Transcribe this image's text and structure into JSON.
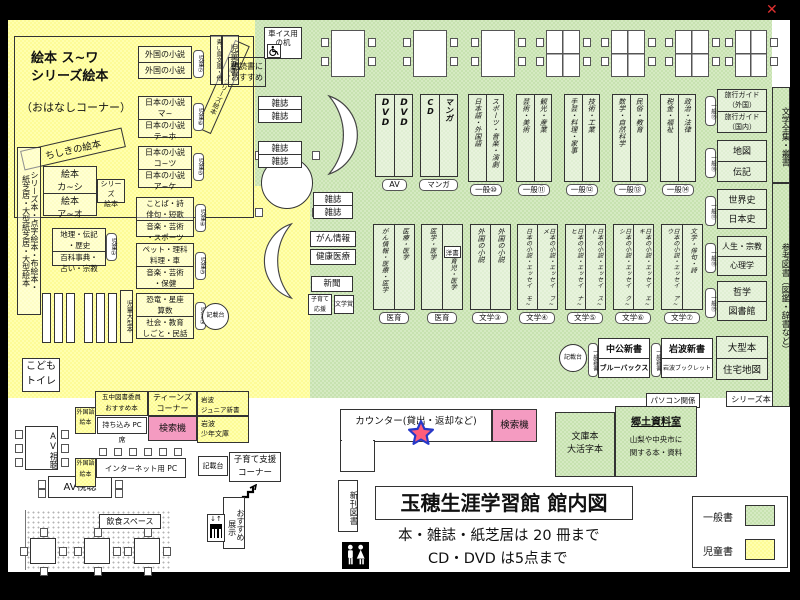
{
  "window": {
    "close": "✕"
  },
  "title": {
    "main": "玉穂生涯学習館 館内図",
    "note1": "本・雑誌・紙芝居は 20 冊まで",
    "note2": "CD・DVD は5点まで"
  },
  "legend": {
    "general_label": "一般書",
    "children_label": "児童書",
    "general_color": "#cde5b4",
    "children_color": "#ffff9e"
  },
  "children": {
    "ohanashi": {
      "l1": "絵本 ス~ワ",
      "l2": "シリーズ絵本",
      "l3": "（おはなしコーナー）",
      "band": "昔話・シリーズ絵本",
      "chishiki": "ちしきの絵本"
    },
    "foreign_novels": {
      "r1": "外国の小説",
      "r2": "外国の小説",
      "badge": "児童⑦"
    },
    "aoitori": "青い鳥文庫・他",
    "jido_shinsho": "児童新書",
    "asadoku": {
      "l1": "朝読書に",
      "l2": "おすすめ"
    },
    "jnovel_ma": {
      "r1a": "日本の小説",
      "r1b": "マ~",
      "r2a": "日本の小説",
      "r2b": "テ~ホ",
      "badge": "児童⑥"
    },
    "jnovel_ko": {
      "r1a": "日本の小説",
      "r1b": "コ~ツ",
      "r2a": "日本の小説",
      "r2b": "ア~ケ",
      "badge": "児童⑤"
    },
    "kotoba": {
      "r1a": "ことば・詩",
      "r1b": "俳句・短歌",
      "r2a": "音楽・芸術",
      "r2b": "・スポーツ",
      "badge": "児童④"
    },
    "pet": {
      "r1a": "ペット・理科",
      "r1b": "料理・車",
      "r2a": "音楽・芸術",
      "r2b": "・保健",
      "badge": "児童③"
    },
    "kyoryu": {
      "r1a": "恐竜・星座",
      "r1b": "算数",
      "r2a": "社会・教育",
      "r2b": "しごと・民話",
      "badge": "児童②"
    },
    "chiri": {
      "r1a": "地理・伝記",
      "r1b": "・歴史",
      "r2a": "百科事典・",
      "r2b": "占い・宗教",
      "badge": "児童①"
    },
    "ehon_ka": {
      "r1a": "絵本",
      "r1b": "カ~シ",
      "r2a": "絵本",
      "r2b": "ア~オ"
    },
    "series_ehon": {
      "l1": "シリーズ",
      "l2": "絵本"
    },
    "tall1": "シリーズ本・点字絵本・布絵本・",
    "tall2": "紙芝居・大型紙芝居・大型絵本",
    "jido_ogata": "児童大型本",
    "toilet": {
      "l1": "こども",
      "l2": "トイレ"
    },
    "kisaidai": "記載台"
  },
  "general": {
    "wheel_desk": {
      "l1": "車イス用",
      "l2": "の机"
    },
    "zasshi": "雑誌",
    "row1": [
      {
        "cols": [
          "DVD",
          "DVD"
        ],
        "label": "AV"
      },
      {
        "cols": [
          "CD",
          "マンガ"
        ],
        "label": "マンガ"
      },
      {
        "cols": [
          "日本語・外国語",
          "スポーツ・音楽・演劇"
        ],
        "label": "一般⑩"
      },
      {
        "cols": [
          "芸術・美術",
          "観光・産業"
        ],
        "label": "一般⑪"
      },
      {
        "cols": [
          "手芸・料理・家事",
          "技術・工業"
        ],
        "label": "一般⑫"
      },
      {
        "cols": [
          "数学・自然科学",
          "民俗・教育"
        ],
        "label": "一般⑬"
      },
      {
        "cols": [
          "税金・福祉",
          "政治・法律"
        ],
        "label": "一般⑭"
      }
    ],
    "row2": [
      {
        "cols": [
          "がん情報・医療・医学",
          "医療・医学"
        ],
        "label": "医育"
      },
      {
        "cols": [
          "医学・医学",
          "育児・医学"
        ],
        "sub": "洋書",
        "label": "医育"
      },
      {
        "cols": [
          "外国の小説",
          "外国の小説"
        ],
        "label": "文学③"
      },
      {
        "cols": [
          "日本の小説・エッセイ モ~",
          "日本の小説・エッセイ フ~メ"
        ],
        "label": "文学④"
      },
      {
        "cols": [
          "日本の小説・エッセイ ナ~ヒ",
          "日本の小説・エッセイ ス~ト"
        ],
        "label": "文学⑤"
      },
      {
        "cols": [
          "日本の小説・エッセイ ク~シ",
          "日本の小説・エッセイ エ~キ"
        ],
        "label": "文学⑥"
      },
      {
        "cols": [
          "日本の小説・エッセイ ア~ウ",
          "文学・俳句・詩"
        ],
        "label": "文学⑦"
      }
    ],
    "gan": "がん情報",
    "kenko": "健康医療",
    "shinbun": "新聞",
    "kosodate_ouen": {
      "l1": "子育て",
      "l2": "応援"
    },
    "bungakusho": "文学賞",
    "kisaidai": "記載台",
    "shinsho_badge": "一般新書",
    "chuko": {
      "r1": "中公新書",
      "r2": "ブルーバックス"
    },
    "iwanami": {
      "r1": "岩波新書",
      "r2": "岩波ブックレット"
    },
    "ogata": {
      "r1": "大型本",
      "r2": "住宅地図"
    },
    "rightcol": [
      {
        "badge": "一般⑮",
        "r1a": "旅行ガイド",
        "r1b": "（外国）",
        "r2a": "旅行ガイド",
        "r2b": "（国内）"
      },
      {
        "badge": "一般⑯",
        "r1": "地図",
        "r2": "伝記"
      },
      {
        "badge": "一般⑰",
        "r1": "世界史",
        "r2": "日本史"
      },
      {
        "badge": "一般⑱",
        "r1": "人生・宗教",
        "r2": "心理学"
      },
      {
        "badge": "一般⑲",
        "r1": "哲学",
        "r2": "図書館"
      }
    ],
    "pasokon": "パソコン関係",
    "series_label": "シリーズ本",
    "strip1": "文学全集・叢書",
    "strip2": "参考図書（図鑑・辞書など）"
  },
  "entrance": {
    "counter": "カウンター(貸出・返却など)",
    "kensakuki": "検索機",
    "shinkan": "新刊図書",
    "bunko": {
      "l1": "文庫本",
      "l2": "大活字本"
    },
    "kyodo": {
      "title": "郷土資料室",
      "l1": "山梨や中央市に",
      "l2": "関する本・資料"
    },
    "gochu": {
      "l1": "五中図書委員",
      "l2": "おすすめ本"
    },
    "teens": {
      "l1": "ティーンズ",
      "l2": "コーナー"
    },
    "iwanami_jr": {
      "l1": "岩波",
      "l2": "ジュニア新書"
    },
    "iwanami_sho": {
      "l1": "岩波",
      "l2": "少年文庫"
    },
    "mochikomi": "持ち込み PC 席",
    "gaikokugo": {
      "l1": "外国語",
      "l2": "絵本"
    },
    "internet": "インターネット用 PC",
    "kosodate": {
      "l1": "子育て支援",
      "l2": "コーナー"
    },
    "osusume": {
      "l1": "おすすめ",
      "l2": "展示"
    },
    "av": "AV視聴",
    "inshoku": "飲食スペース"
  }
}
